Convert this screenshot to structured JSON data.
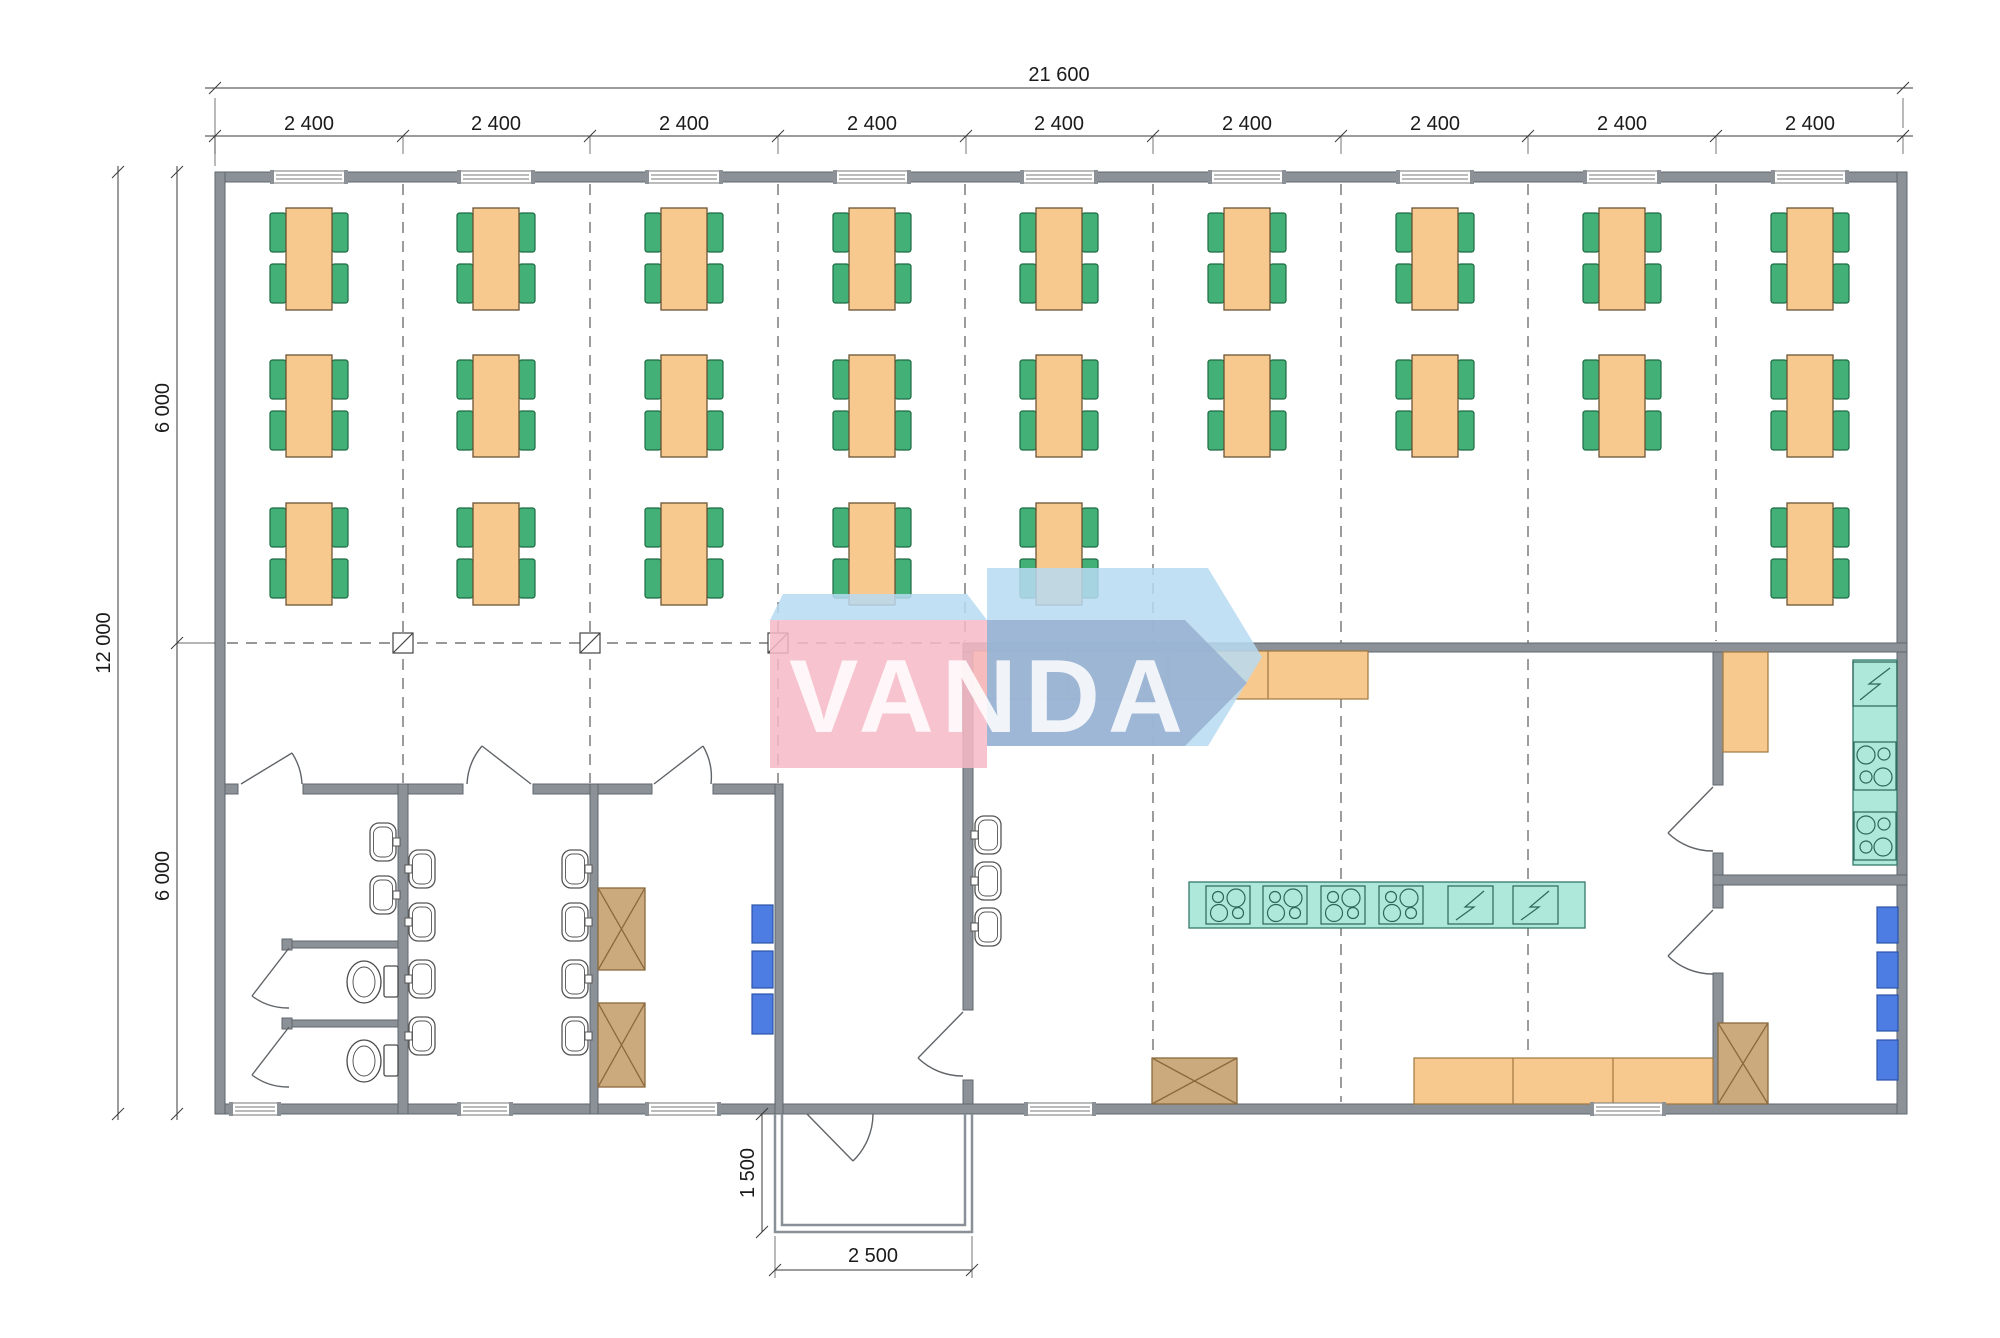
{
  "watermark": {
    "text": "VANDA"
  },
  "dimensions": {
    "overall_width": "21 600",
    "bays": [
      "2 400",
      "2 400",
      "2 400",
      "2 400",
      "2 400",
      "2 400",
      "2 400",
      "2 400",
      "2 400"
    ],
    "overall_height": "12 000",
    "height_upper": "6 000",
    "height_lower": "6 000",
    "porch_depth": "1 500",
    "porch_width": "2 500"
  },
  "colors": {
    "wall": "#8b9196",
    "wall_edge": "#5f666d",
    "table": "#f8c98f",
    "table_edge": "#6b5535",
    "chair": "#42b077",
    "chair_edge": "#1d6b43",
    "counter": "#f8c98f",
    "counter_edge": "#a07840",
    "appliance_teal": "#ade8da",
    "appliance_teal_edge": "#35786a",
    "fridge_blue": "#4d7ce2",
    "fridge_blue_edge": "#2c55a8",
    "cabinet_brown": "#cbaa7e",
    "cabinet_brown_edge": "#8a6a3e",
    "watermark_pink": "rgba(246,184,198,0.85)",
    "watermark_pale_blue": "rgba(183,219,242,0.85)",
    "watermark_slate_blue": "rgba(148,172,206,0.78)"
  },
  "floorplan": {
    "tables": {
      "bay_centers": [
        309,
        496,
        684,
        872,
        1059,
        1247,
        1435,
        1622,
        1810
      ],
      "rows": [
        {
          "y": 208,
          "bays": [
            1,
            2,
            3,
            4,
            5,
            6,
            7,
            8,
            9
          ]
        },
        {
          "y": 355,
          "bays": [
            1,
            2,
            3,
            4,
            5,
            6,
            7,
            8,
            9
          ]
        },
        {
          "y": 503,
          "bays": [
            1,
            2,
            3,
            4,
            5,
            9
          ]
        }
      ],
      "table_count": 24,
      "chairs_per_table": 4
    },
    "windows": {
      "top_centers": [
        309,
        496,
        684,
        872,
        1059,
        1247,
        1435,
        1622,
        1810
      ],
      "top_width": 72,
      "bottom": [
        {
          "x": 232,
          "w": 46
        },
        {
          "x": 460,
          "w": 50
        },
        {
          "x": 648,
          "w": 70
        },
        {
          "x": 1027,
          "w": 66
        },
        {
          "x": 1593,
          "w": 70
        }
      ]
    },
    "basins": [
      {
        "x": 370,
        "y": 823,
        "tap": "r"
      },
      {
        "x": 370,
        "y": 876,
        "tap": "r"
      },
      {
        "x": 409,
        "y": 850,
        "tap": "l"
      },
      {
        "x": 409,
        "y": 903,
        "tap": "l"
      },
      {
        "x": 409,
        "y": 960,
        "tap": "l"
      },
      {
        "x": 409,
        "y": 1017,
        "tap": "l"
      },
      {
        "x": 562,
        "y": 850,
        "tap": "r"
      },
      {
        "x": 562,
        "y": 903,
        "tap": "r"
      },
      {
        "x": 562,
        "y": 960,
        "tap": "r"
      },
      {
        "x": 562,
        "y": 1017,
        "tap": "r"
      },
      {
        "x": 975,
        "y": 816,
        "tap": "l"
      },
      {
        "x": 975,
        "y": 862,
        "tap": "l"
      },
      {
        "x": 975,
        "y": 908,
        "tap": "l"
      }
    ],
    "rooms": [
      {
        "name": "dining-hall",
        "tables": 24,
        "chairs": 96
      },
      {
        "name": "toilet-room",
        "toilets": 2,
        "stalls": 2,
        "washbasins": 2
      },
      {
        "name": "washroom",
        "washbasins": 8
      },
      {
        "name": "storage-room",
        "crossed-cabinets": 2,
        "refrigerators": 3
      },
      {
        "name": "entrance-vestibule",
        "exit-door": 1
      },
      {
        "name": "kitchen",
        "washbasins": 3,
        "stove-modules": 4,
        "sink-modules": 2,
        "counters": 2,
        "crossed-cabinets": 1
      },
      {
        "name": "pantry-room",
        "sink-modules": 1,
        "stove-modules": 2,
        "cabinets": 1
      },
      {
        "name": "cold-room",
        "refrigerators": 4,
        "crossed-cabinets": 1
      }
    ]
  }
}
